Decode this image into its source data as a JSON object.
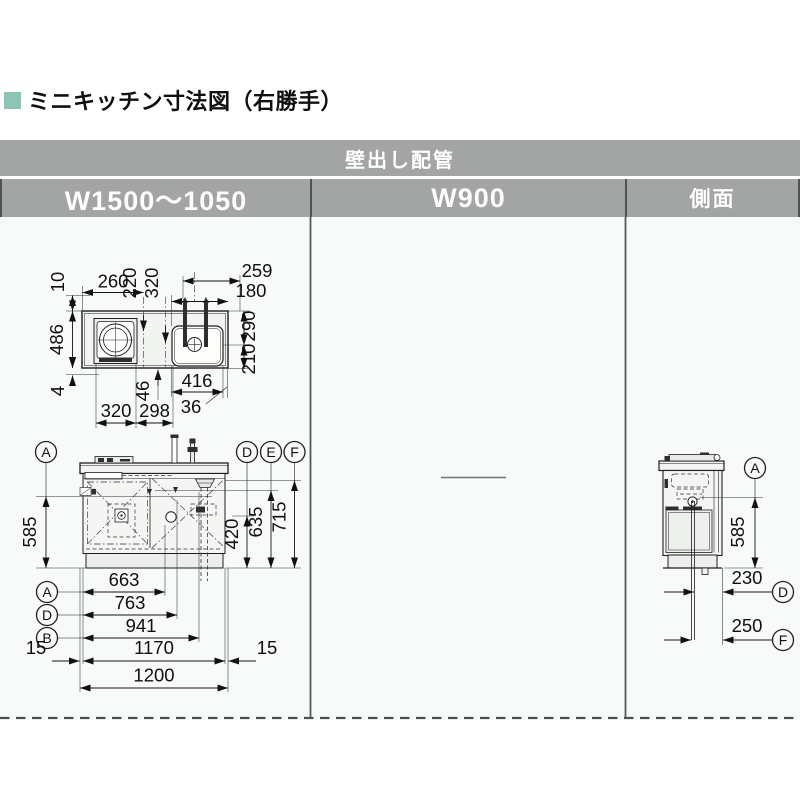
{
  "title": {
    "heading": "ミニキッチン寸法図（右勝手）"
  },
  "colors": {
    "accent": "#8cc5b5",
    "header_bg": "#a2a5a4",
    "header_text": "#ffffff",
    "drawing_bg": "#f7faf9"
  },
  "table": {
    "banner": "壁出し配管",
    "columns": [
      {
        "label": "W1500～1050"
      },
      {
        "label": "W900"
      },
      {
        "label": "側面"
      }
    ]
  },
  "plan_view": {
    "d10": "10",
    "d260": "260",
    "d220": "220",
    "d320_top": "320",
    "d259": "259",
    "d180": "180",
    "d290": "290",
    "d210": "210",
    "d486": "486",
    "d4": "4",
    "d46": "46",
    "d320_bottom": "320",
    "d298": "298",
    "d416": "416",
    "d36": "36"
  },
  "front_view": {
    "d585": "585",
    "d420": "420",
    "d635": "635",
    "d715": "715",
    "d663": "663",
    "d763": "763",
    "d941": "941",
    "d15_left": "15",
    "d1170": "1170",
    "d15_right": "15",
    "d1200": "1200",
    "ref_a_top": "A",
    "ref_d_top": "D",
    "ref_e_top": "E",
    "ref_f_top": "F",
    "ref_a_bottom": "A",
    "ref_d_bottom": "D",
    "ref_b_bottom": "B"
  },
  "side_view": {
    "d585": "585",
    "d230": "230",
    "d250": "250",
    "ref_a": "A",
    "ref_d": "D",
    "ref_f": "F"
  }
}
